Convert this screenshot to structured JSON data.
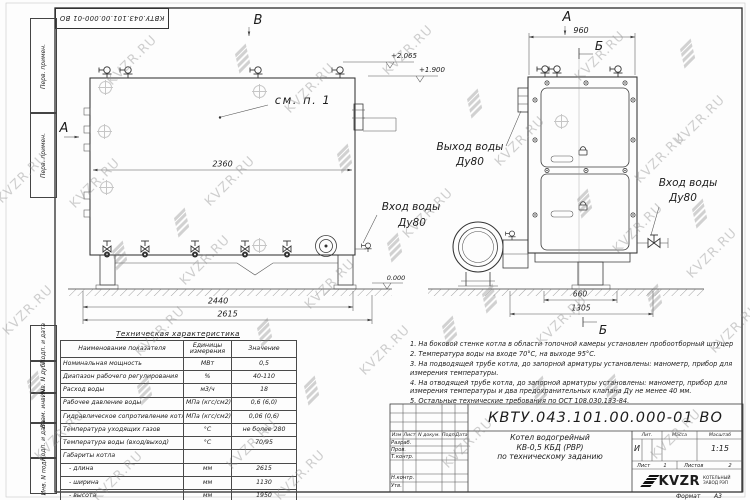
{
  "doc": {
    "number": "КВТУ.043.101.00.000-01 ВО",
    "format_label": "Формат",
    "format_value": "А3"
  },
  "watermark": {
    "text": "KVZR.RU"
  },
  "margin_labels": [
    "Перв. примен.",
    "Перв. примен.",
    "Подп. и дата",
    "Инв. N дубл.",
    "Взам. инв. N",
    "Подп. и дата",
    "Инв. N подл."
  ],
  "drawing": {
    "labels": {
      "view_a": "А",
      "view_b": "Б",
      "view_v": "В"
    },
    "annotations": {
      "see_note": "см. п. 1",
      "water_in": "Вход воды",
      "water_out": "Выход воды",
      "dn": "Ду80"
    },
    "dims": {
      "l_top": "2360",
      "l_base": "2440",
      "l_total": "2615",
      "f_top": "960",
      "f_base": "660",
      "f_total": "1305"
    },
    "elevations": {
      "e1": "+2.065",
      "e2": "+1.900",
      "e0": "0.000"
    }
  },
  "spec_table": {
    "title": "Техническая характеристика",
    "headers": [
      "Наименование показателя",
      "Единицы измерения",
      "Значение"
    ],
    "rows": [
      [
        "Номинальная мощность",
        "МВт",
        "0,5"
      ],
      [
        "Диапазон рабочего регулирования",
        "%",
        "40-110"
      ],
      [
        "Расход воды",
        "м3/ч",
        "18"
      ],
      [
        "Рабочее давление воды",
        "МПа (кгс/см2)",
        "0,6 (6,0)"
      ],
      [
        "Гидравлическое сопротивление котла",
        "МПа (кгс/см2)",
        "0,06 (0,6)"
      ],
      [
        "Температура уходящих газов",
        "°С",
        "не более 280"
      ],
      [
        "Температура воды (вход/выход)",
        "°С",
        "70/95"
      ],
      [
        "Габариты котла",
        "",
        ""
      ],
      [
        "- длина",
        "мм",
        "2615"
      ],
      [
        "- ширина",
        "мм",
        "1130"
      ],
      [
        "- высота",
        "мм",
        "1950"
      ]
    ]
  },
  "notes": [
    "1. На боковой стенке котла в области топочной камеры установлен пробоотборный штуцер",
    "2. Температура воды на входе 70°С, на выходе 95°С.",
    "3. На подводящей трубе котла, до запорной арматуры установлены: манометр, прибор для измерения температуры.",
    "4. На отводящей трубе котла, до запорной арматуры установлены: манометр, прибор для измерения температуры и два предохранительных клапана Ду не менее 40 мм.",
    "5. Остальные технические требования по ОСТ 108.030.133-84."
  ],
  "title_block": {
    "change_header": [
      "Изм",
      "Лист",
      "N докум.",
      "Подп.",
      "Дата"
    ],
    "row_labels": [
      "Разраб.",
      "Пров.",
      "Т.контр.",
      "Н.контр.",
      "Утв."
    ],
    "name_lines": [
      "Котел водогрейный",
      "КВ-0,5 КБД (РВР)",
      "по техническому заданию"
    ],
    "lit_headers": [
      "Лит.",
      "Масса",
      "Масштаб"
    ],
    "lit_value": "И",
    "scale_value": "1:15",
    "sheet_label": "Лист",
    "sheet_value": "1",
    "sheets_label": "Листов",
    "sheets_value": "2",
    "logo_text": "KVZR",
    "logo_sub1": "КОТЕЛЬНЫЙ",
    "logo_sub2": "ЗАВОД РЭП"
  }
}
